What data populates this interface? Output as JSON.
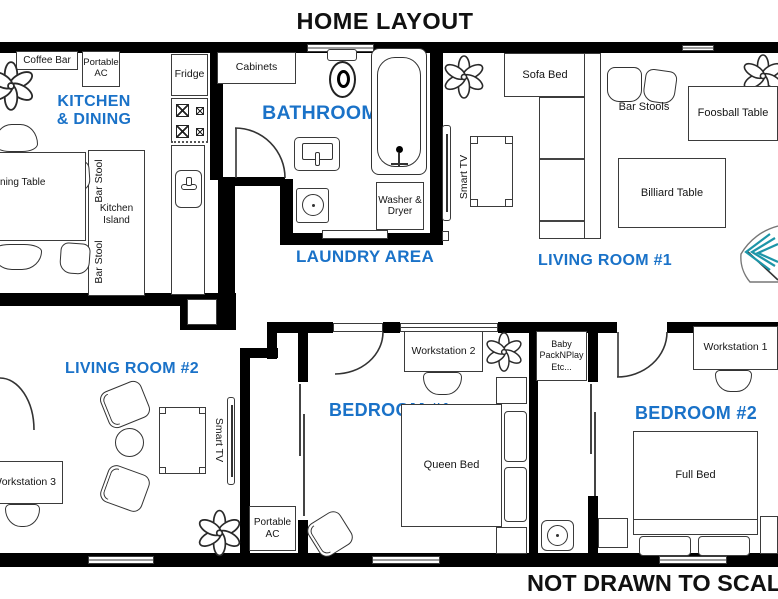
{
  "title": "HOME LAYOUT",
  "footer": "NOT DRAWN TO SCALE",
  "colors": {
    "room_label_blue": "#1a72c8",
    "wall_black": "#000000",
    "plant_teal": "#1d95a8"
  },
  "rooms": {
    "kitchen_dining": {
      "label": "KITCHEN & DINING",
      "coffee_bar": "Coffee Bar",
      "portable_ac": "Portable AC",
      "fridge": "Fridge",
      "kitchen_island": "Kitchen Island",
      "bar_stool": "Bar Stool",
      "dining_table": "Dining Table"
    },
    "bathroom": {
      "label": "BATHROOM",
      "cabinets": "Cabinets"
    },
    "laundry": {
      "label": "LAUNDRY AREA",
      "washer_dryer": "Washer & Dryer"
    },
    "living_room_1": {
      "label": "LIVING ROOM #1",
      "sofa_bed": "Sofa Bed",
      "bar_stools": "Bar Stools",
      "foosball_table": "Foosball Table",
      "billiard_table": "Billiard Table",
      "smart_tv": "Smart TV"
    },
    "living_room_2": {
      "label": "LIVING ROOM #2",
      "workstation_3": "Workstation 3",
      "smart_tv": "Smart TV"
    },
    "bedroom_1": {
      "label": "BEDROOM #1",
      "workstation_2": "Workstation 2",
      "queen_bed": "Queen Bed",
      "portable_ac": "Portable AC"
    },
    "bedroom_2": {
      "label": "BEDROOM #2",
      "workstation_1": "Workstation 1",
      "full_bed": "Full Bed",
      "baby_packnplay": "Baby PackNPlay Etc..."
    }
  }
}
